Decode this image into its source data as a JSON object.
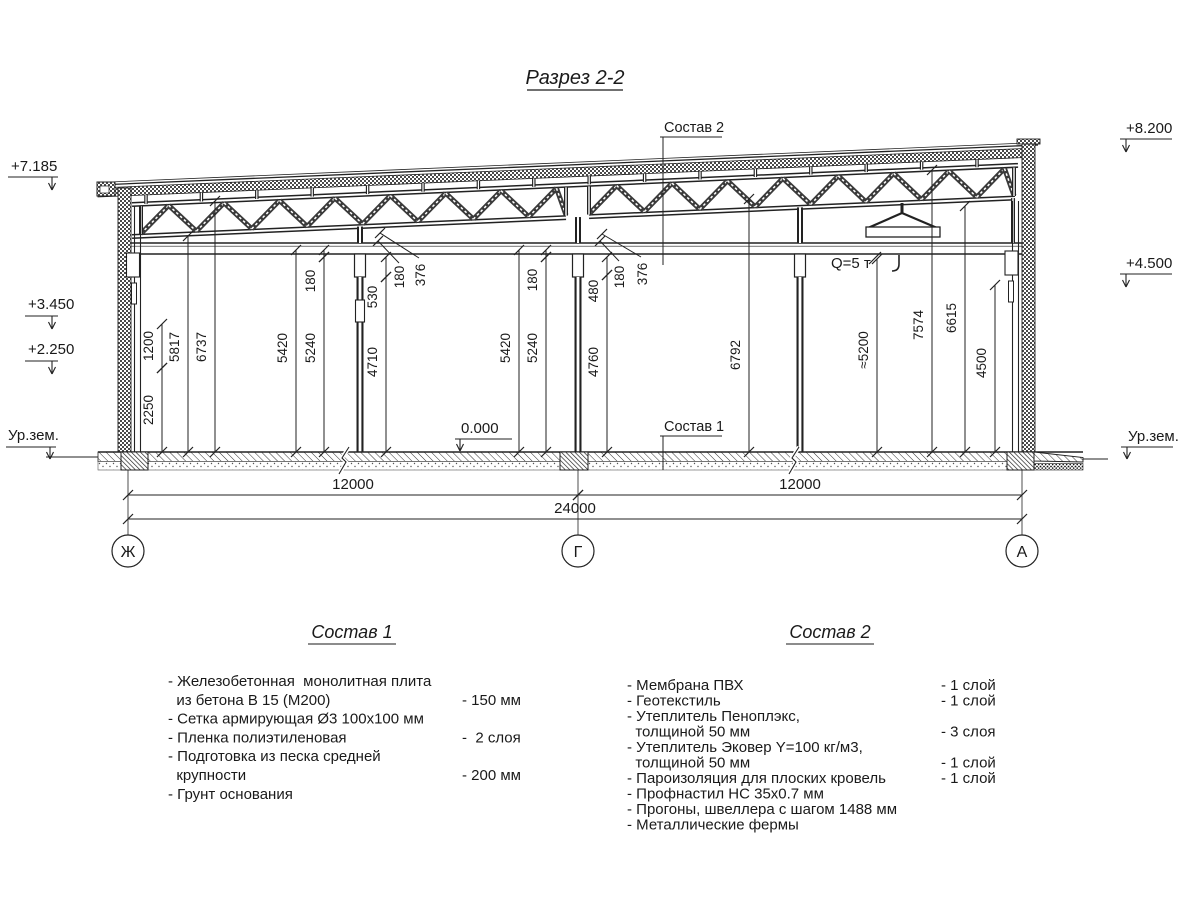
{
  "title": "Разрез 2-2",
  "colors": {
    "line": "#1a1a1a",
    "background": "#ffffff"
  },
  "section": {
    "elevation_marks_left": [
      {
        "label": "+7.185"
      },
      {
        "label": "+3.450"
      },
      {
        "label": "+2.250"
      },
      {
        "label": "Ур.зем."
      }
    ],
    "elevation_marks_right": [
      {
        "label": "+8.200"
      },
      {
        "label": "+4.500"
      },
      {
        "label": "Ур.зем."
      }
    ],
    "floor_mark": {
      "label": "0.000"
    },
    "callout_top": {
      "label": "Состав 2"
    },
    "callout_floor": {
      "label": "Состав 1"
    },
    "crane_label": {
      "label": "Q=5 т"
    },
    "axes": [
      {
        "label": "Ж"
      },
      {
        "label": "Г"
      },
      {
        "label": "А"
      }
    ],
    "dimensions_horizontal": [
      {
        "id": "dim-bay-left",
        "label": "12000"
      },
      {
        "id": "dim-bay-right",
        "label": "12000"
      },
      {
        "id": "dim-total",
        "label": "24000"
      }
    ],
    "dimensions_vertical": [
      {
        "id": "dim-2250",
        "label": "2250"
      },
      {
        "id": "dim-1200",
        "label": "1200"
      },
      {
        "id": "dim-5817",
        "label": "5817"
      },
      {
        "id": "dim-6737",
        "label": "6737"
      },
      {
        "id": "dim-5420-left",
        "label": "5420"
      },
      {
        "id": "dim-5240-left",
        "label": "5240"
      },
      {
        "id": "dim-180-left",
        "label": "180"
      },
      {
        "id": "dim-530",
        "label": "530"
      },
      {
        "id": "dim-4710",
        "label": "4710"
      },
      {
        "id": "dim-180-left2",
        "label": "180"
      },
      {
        "id": "dim-376-left",
        "label": "376"
      },
      {
        "id": "dim-5420-mid",
        "label": "5420"
      },
      {
        "id": "dim-5240-mid",
        "label": "5240"
      },
      {
        "id": "dim-180-mid",
        "label": "180"
      },
      {
        "id": "dim-480",
        "label": "480"
      },
      {
        "id": "dim-4760",
        "label": "4760"
      },
      {
        "id": "dim-180-mid2",
        "label": "180"
      },
      {
        "id": "dim-376-mid",
        "label": "376"
      },
      {
        "id": "dim-6792",
        "label": "6792"
      },
      {
        "id": "dim-5200",
        "label": "≈5200"
      },
      {
        "id": "dim-7574",
        "label": "7574"
      },
      {
        "id": "dim-6615",
        "label": "6615"
      },
      {
        "id": "dim-4500",
        "label": "4500"
      }
    ]
  },
  "legend_1": {
    "title": "Состав 1",
    "items": [
      {
        "text": "- Железобетонная  монолитная плита",
        "value": ""
      },
      {
        "text": "  из бетона В 15 (М200)",
        "value": "- 150 мм"
      },
      {
        "text": "- Сетка армирующая Ø3 100х100 мм",
        "value": ""
      },
      {
        "text": "- Пленка полиэтиленовая",
        "value": "-  2 слоя"
      },
      {
        "text": "- Подготовка из песка средней",
        "value": ""
      },
      {
        "text": "  крупности",
        "value": "- 200 мм"
      },
      {
        "text": "- Грунт основания",
        "value": ""
      }
    ]
  },
  "legend_2": {
    "title": "Состав 2",
    "items": [
      {
        "text": "- Мембрана ПВХ",
        "value": "- 1 слой"
      },
      {
        "text": "- Геотекстиль",
        "value": "- 1 слой"
      },
      {
        "text": "- Утеплитель Пеноплэкс,",
        "value": ""
      },
      {
        "text": "  толщиной 50 мм",
        "value": "- 3 слоя"
      },
      {
        "text": "- Утеплитель Эковер Y=100 кг/м3,",
        "value": ""
      },
      {
        "text": "  толщиной 50 мм",
        "value": "- 1 слой"
      },
      {
        "text": "- Пароизоляция для плоских кровель",
        "value": "- 1 слой"
      },
      {
        "text": "- Профнастил НС 35х0.7 мм",
        "value": ""
      },
      {
        "text": "- Прогоны, швеллера с шагом 1488 мм",
        "value": ""
      },
      {
        "text": "- Металлические фермы",
        "value": ""
      }
    ]
  }
}
